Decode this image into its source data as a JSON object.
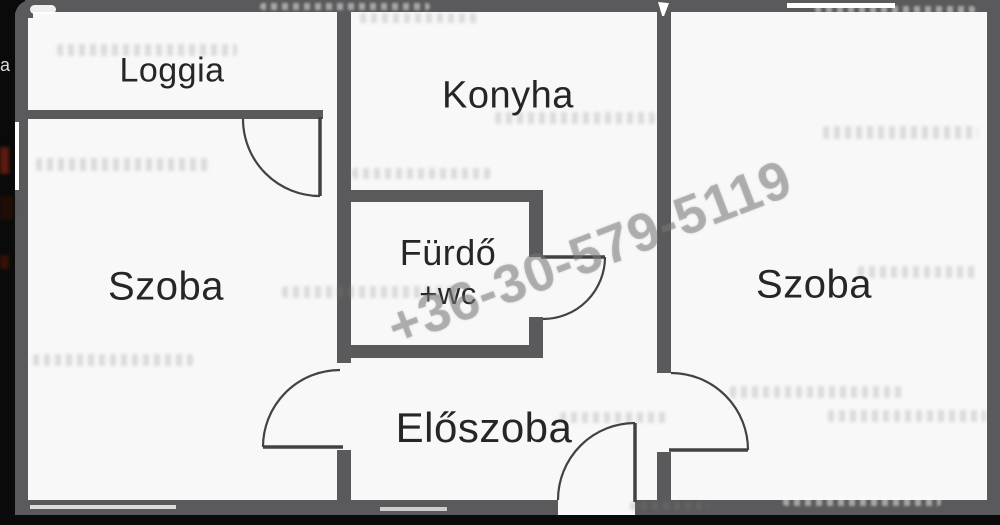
{
  "rooms": {
    "loggia": "Loggia",
    "szoba_left": "Szoba",
    "konyha": "Konyha",
    "furdo_line1": "Fürdő",
    "furdo_line2": "+wc",
    "eloszoba": "Előszoba",
    "szoba_right": "Szoba"
  },
  "watermark": {
    "phone": "+36-30-579-5119"
  },
  "left_edge_fragment": "la",
  "colors": {
    "wall": "#5a5a5c",
    "room_fill": "#f8f8f8",
    "backdrop": "#0a0a0a",
    "label_text": "#262626",
    "door_line": "#424242",
    "watermark_gray": "#b9b9b9",
    "left_edge_blob_red": "#5c1a10"
  }
}
